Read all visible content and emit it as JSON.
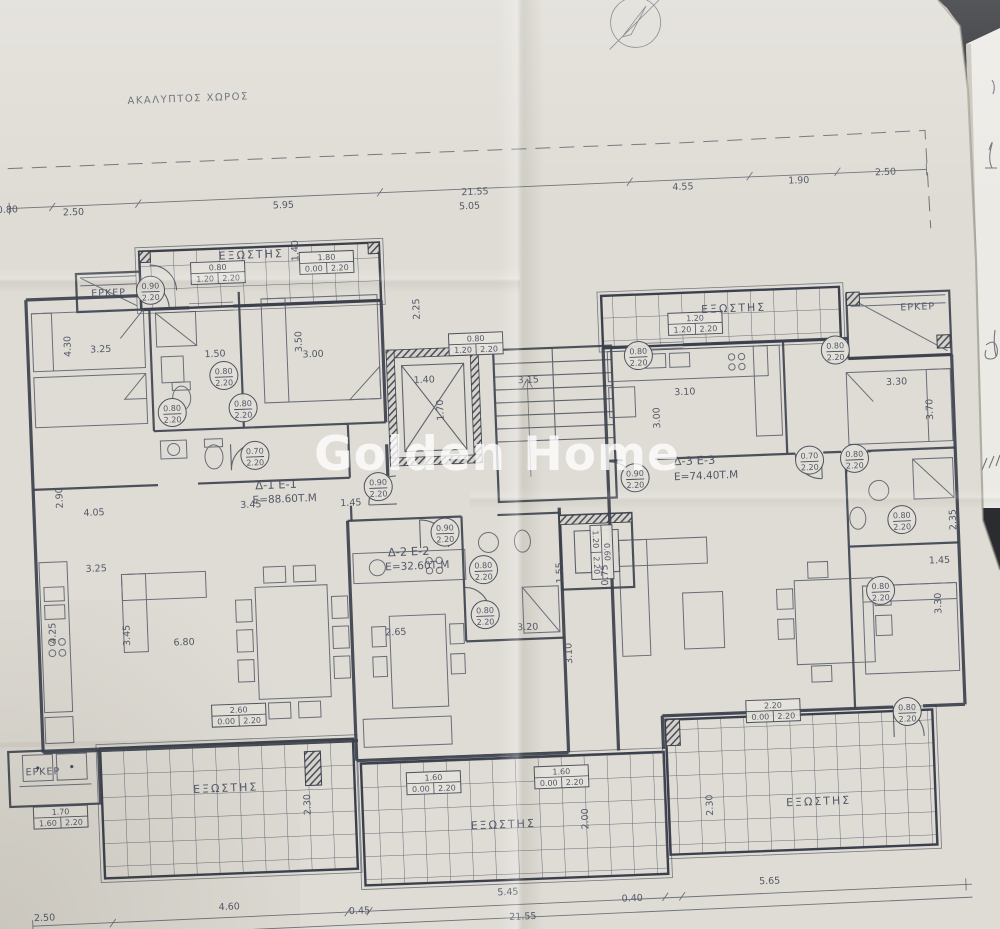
{
  "meta": {
    "title": "Photo of architectural floor plan drawing",
    "watermark": "Golden Home"
  },
  "plan": {
    "site_label": "ΑΚΑΛΥΠΤΟΣ ΧΩΡΟΣ",
    "balcony_label": "ΕΞΩΣΤΗΣ",
    "bay_label": "ΕΡΚΕΡ",
    "door_height": "2.20",
    "apartments": [
      {
        "id": "Δ-1 Ε-1",
        "area": "Ε=88.60Τ.Μ"
      },
      {
        "id": "Δ-2 Ε-2",
        "area": "Ε=32.60Τ.Μ"
      },
      {
        "id": "Δ-3 Ε-3",
        "area": "Ε=74.40Τ.Μ"
      }
    ]
  },
  "colors": {
    "ink": "#474d5a",
    "wall": "#3b404c",
    "paper": "#dfdcd5",
    "side_paper": "#eceae5",
    "table": "#2a2c30",
    "watermark": "#ffffff"
  },
  "labels": [
    {
      "t": "ΑΚΑΛΥΠΤΟΣ ΧΩΡΟΣ",
      "x": 205,
      "y": 90,
      "cls": "site"
    },
    {
      "t": "21.55",
      "x": 488,
      "y": 194,
      "fs": 10
    },
    {
      "t": "5.05",
      "x": 482,
      "y": 208
    },
    {
      "t": "0.80",
      "x": 20,
      "y": 194
    },
    {
      "t": "2.50",
      "x": 86,
      "y": 199
    },
    {
      "t": "5.95",
      "x": 296,
      "y": 200
    },
    {
      "t": "4.55",
      "x": 696,
      "y": 197
    },
    {
      "t": "1.90",
      "x": 812,
      "y": 195
    },
    {
      "t": "2.50",
      "x": 899,
      "y": 190
    },
    {
      "t": "ΕΞΩΣΤΗΣ",
      "x": 262,
      "y": 249,
      "cls": "room"
    },
    {
      "t": "ΕΞΩΣΤΗΣ",
      "x": 742,
      "y": 321,
      "cls": "room"
    },
    {
      "t": "ΕΞΩΣΤΗΣ",
      "x": 216,
      "y": 781,
      "cls": "room"
    },
    {
      "t": "ΕΞΩΣΤΗΣ",
      "x": 492,
      "y": 828,
      "cls": "room"
    },
    {
      "t": "ΕΞΩΣΤΗΣ",
      "x": 808,
      "y": 817,
      "cls": "room"
    },
    {
      "t": "ΕΡΚΕΡ",
      "x": 118,
      "y": 281,
      "cls": "bay"
    },
    {
      "t": "ΕΡΚΕΡ",
      "x": 926,
      "y": 326,
      "cls": "bay"
    },
    {
      "t": "ΕΡΚΕΡ",
      "x": 34,
      "y": 757,
      "cls": "bay"
    },
    {
      "t": "Δ-1 Ε-1",
      "x": 278,
      "y": 480,
      "cls": "apt"
    },
    {
      "t": "Ε=88.60Τ.Μ",
      "x": 286,
      "y": 494,
      "cls": "area"
    },
    {
      "t": "Δ-2 Ε-2",
      "x": 408,
      "y": 552,
      "cls": "apt"
    },
    {
      "t": "Ε=32.60Τ.Μ",
      "x": 416,
      "y": 566,
      "cls": "area"
    },
    {
      "t": "Δ-3 Ε-3",
      "x": 697,
      "y": 472,
      "cls": "apt"
    },
    {
      "t": "Ε=74.40Τ.Μ",
      "x": 708,
      "y": 487,
      "cls": "area"
    },
    {
      "t": "3.25",
      "x": 108,
      "y": 337
    },
    {
      "t": "4.30",
      "x": 78,
      "y": 330,
      "r": -90
    },
    {
      "t": "1.50",
      "x": 222,
      "y": 346
    },
    {
      "t": "3.50",
      "x": 309,
      "y": 334,
      "r": -90
    },
    {
      "t": "3.00",
      "x": 320,
      "y": 350
    },
    {
      "t": "1.40",
      "x": 309,
      "y": 243,
      "r": -90
    },
    {
      "t": "2.25",
      "x": 428,
      "y": 306,
      "r": -90
    },
    {
      "t": "1.40",
      "x": 430,
      "y": 380
    },
    {
      "t": "1.70",
      "x": 448,
      "y": 408,
      "r": -90
    },
    {
      "t": "3.15",
      "x": 534,
      "y": 384
    },
    {
      "t": "3.45",
      "x": 252,
      "y": 498
    },
    {
      "t": "1.45",
      "x": 352,
      "y": 500
    },
    {
      "t": "2.90",
      "x": 64,
      "y": 481,
      "r": -90
    },
    {
      "t": "4.05",
      "x": 95,
      "y": 500
    },
    {
      "t": "3.25",
      "x": 95,
      "y": 556
    },
    {
      "t": "4.25",
      "x": 52,
      "y": 616,
      "r": -90
    },
    {
      "t": "3.45",
      "x": 126,
      "y": 621,
      "r": -90
    },
    {
      "t": "6.80",
      "x": 180,
      "y": 633
    },
    {
      "t": "2.65",
      "x": 392,
      "y": 631
    },
    {
      "t": "3.20",
      "x": 524,
      "y": 631
    },
    {
      "t": "3.10",
      "x": 567,
      "y": 656,
      "r": -90
    },
    {
      "t": "1.55",
      "x": 561,
      "y": 575,
      "r": -90
    },
    {
      "t": "0.75",
      "x": 606,
      "y": 579,
      "r": -90
    },
    {
      "t": "3.10",
      "x": 690,
      "y": 402
    },
    {
      "t": "3.00",
      "x": 664,
      "y": 424,
      "r": -90
    },
    {
      "t": "3.30",
      "x": 902,
      "y": 400
    },
    {
      "t": "3.70",
      "x": 937,
      "y": 426,
      "r": -90
    },
    {
      "t": "2.35",
      "x": 956,
      "y": 537,
      "r": -90
    },
    {
      "t": "1.45",
      "x": 938,
      "y": 580
    },
    {
      "t": "3.30",
      "x": 938,
      "y": 620,
      "r": -90
    },
    {
      "t": "2.30",
      "x": 300,
      "y": 797,
      "r": -90
    },
    {
      "t": "2.00",
      "x": 577,
      "y": 822,
      "r": -90
    },
    {
      "t": "2.30",
      "x": 702,
      "y": 813,
      "r": -90
    },
    {
      "t": "2.50",
      "x": 30,
      "y": 903
    },
    {
      "t": "4.60",
      "x": 215,
      "y": 899
    },
    {
      "t": "0.45",
      "x": 345,
      "y": 908
    },
    {
      "t": "5.45",
      "x": 494,
      "y": 895
    },
    {
      "t": "0.40",
      "x": 618,
      "y": 906
    },
    {
      "t": "5.65",
      "x": 756,
      "y": 894
    },
    {
      "t": "21.55",
      "x": 508,
      "y": 920,
      "fs": 10
    },
    {
      "t": "Golden Home",
      "x": 497,
      "y": 470,
      "cls": "wm"
    }
  ],
  "doors": [
    {
      "v": "0.90",
      "x": 160,
      "y": 277
    },
    {
      "v": "0.80",
      "x": 230,
      "y": 365
    },
    {
      "v": "0.80",
      "x": 177,
      "y": 400
    },
    {
      "v": "0.80",
      "x": 248,
      "y": 398
    },
    {
      "v": "0.70",
      "x": 258,
      "y": 446
    },
    {
      "v": "0.90",
      "x": 380,
      "y": 482
    },
    {
      "v": "0.90",
      "x": 445,
      "y": 530
    },
    {
      "v": "0.80",
      "x": 482,
      "y": 569
    },
    {
      "v": "0.80",
      "x": 482,
      "y": 614
    },
    {
      "v": "0.80",
      "x": 645,
      "y": 361
    },
    {
      "v": "0.80",
      "x": 842,
      "y": 363
    },
    {
      "v": "0.90",
      "x": 637,
      "y": 483
    },
    {
      "v": "0.70",
      "x": 812,
      "y": 472
    },
    {
      "v": "0.80",
      "x": 857,
      "y": 472
    },
    {
      "v": "0.80",
      "x": 902,
      "y": 535
    },
    {
      "v": "0.80",
      "x": 878,
      "y": 605
    },
    {
      "v": "0.80",
      "x": 900,
      "y": 727
    }
  ],
  "windows": [
    {
      "w": "1.80",
      "a": "0.00",
      "b": "2.20",
      "x": 337,
      "y": 256
    },
    {
      "w": "0.80",
      "a": "1.20",
      "b": "2.20",
      "x": 228,
      "y": 262
    },
    {
      "w": "0.80",
      "a": "1.20",
      "b": "2.20",
      "x": 483,
      "y": 343
    },
    {
      "w": "1.20",
      "a": "1.20",
      "b": "2.20",
      "x": 703,
      "y": 331
    },
    {
      "w": "2.60",
      "a": "0.00",
      "b": "2.20",
      "x": 232,
      "y": 705
    },
    {
      "w": "1.60",
      "a": "0.00",
      "b": "2.20",
      "x": 424,
      "y": 780
    },
    {
      "w": "1.60",
      "a": "0.00",
      "b": "2.20",
      "x": 552,
      "y": 779
    },
    {
      "w": "2.20",
      "a": "0.00",
      "b": "2.20",
      "x": 766,
      "y": 721
    },
    {
      "w": "1.70",
      "a": "1.60",
      "b": "2.20",
      "x": 50,
      "y": 800
    },
    {
      "w": "0.60",
      "a": "1.20",
      "b": "2.20",
      "x": 601,
      "y": 556,
      "r": 90
    }
  ]
}
